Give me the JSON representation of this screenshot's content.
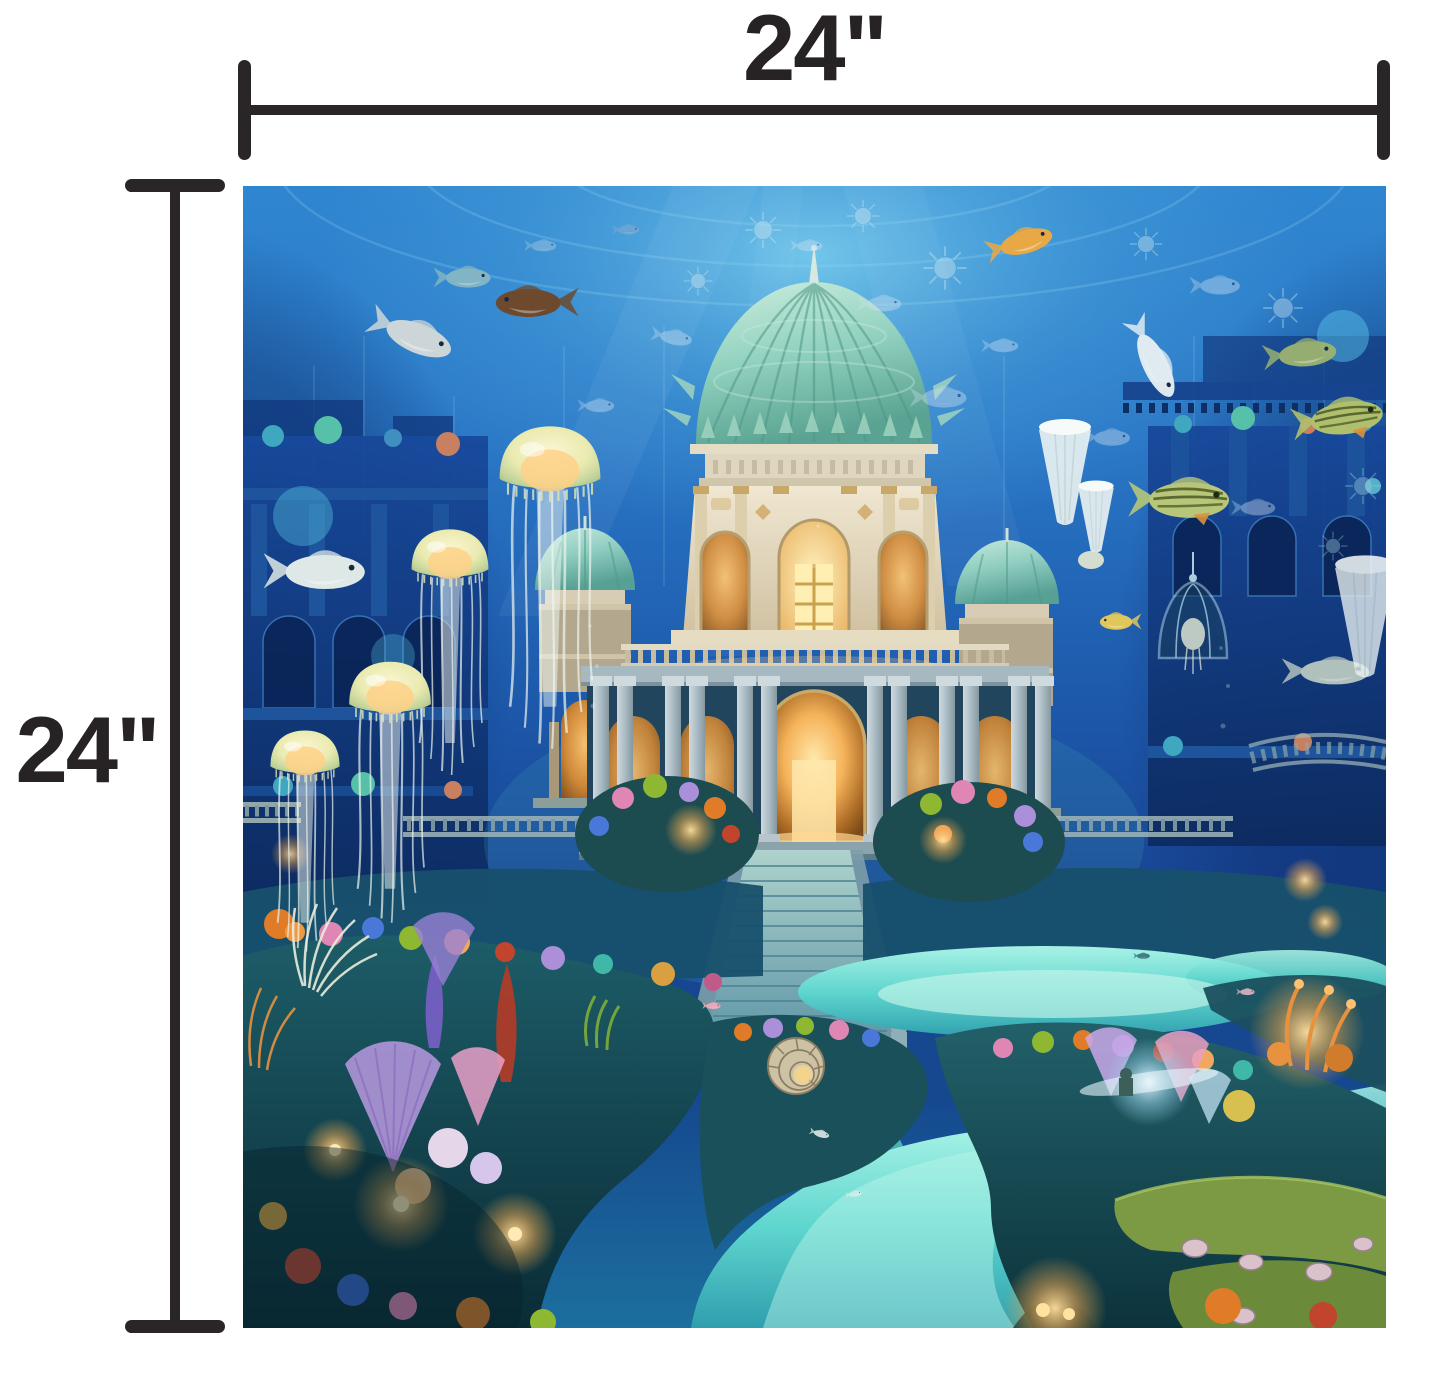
{
  "page": {
    "background_color": "#ffffff"
  },
  "dimension_annotations": {
    "line_color": "#2a2627",
    "top": {
      "label": "24\""
    },
    "left": {
      "label": "24\""
    }
  },
  "artwork": {
    "alt": "Underwater fantasy palace art print: teal ribbed domes, glowing golden archways and staircase, jellyfish, tropical fish, sunken ruins and a colorful coral reef with a turquoise channel",
    "palette": {
      "water_top": "#2f86d0",
      "water_deep": "#123a8c",
      "channel_turquoise": "#5fd6ce",
      "dome_teal": "#8ed1c5",
      "stone_cream": "#ece2cc",
      "glow_amber": "#ffd27f",
      "coral_orange": "#e07c28",
      "coral_pink": "#e086b4",
      "coral_lavender": "#ab8fd8",
      "rock_teal": "#14454f"
    }
  }
}
